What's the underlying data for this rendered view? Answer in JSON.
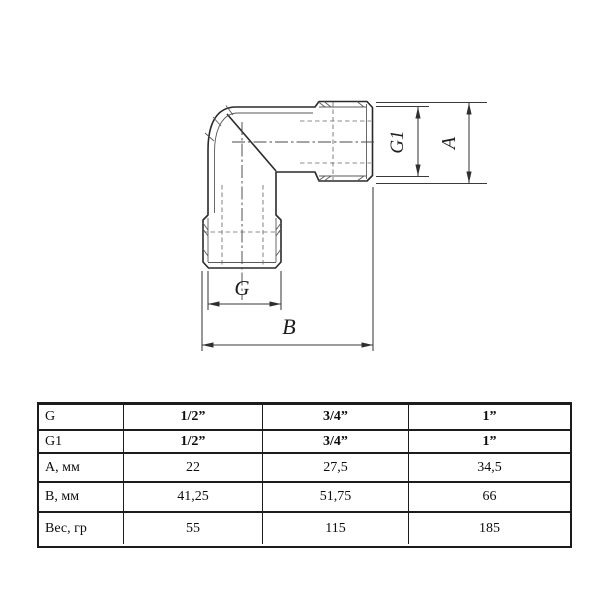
{
  "drawing": {
    "description": "90-degree elbow pipe fitting with two external threaded ends, orthographic view with dimensions",
    "dim_labels": {
      "g": "G",
      "g1": "G1",
      "a": "A",
      "b": "B"
    }
  },
  "table": {
    "rows": [
      {
        "label": "G",
        "values": [
          "1/2”",
          "3/4”",
          "1”"
        ]
      },
      {
        "label": "G1",
        "values": [
          "1/2”",
          "3/4”",
          "1”"
        ]
      },
      {
        "label": "А, мм",
        "values": [
          "22",
          "27,5",
          "34,5"
        ]
      },
      {
        "label": "В, мм",
        "values": [
          "41,25",
          "51,75",
          "66"
        ]
      },
      {
        "label": "Вес, гр",
        "values": [
          "55",
          "115",
          "185"
        ]
      }
    ]
  },
  "colors": {
    "background": "#ffffff",
    "outline": "#2a2a2a",
    "thin_line": "#5a5a5a",
    "dimension_line": "#3a3a3a",
    "table_border": "#1c1c1c",
    "text": "#0d0d0d"
  }
}
